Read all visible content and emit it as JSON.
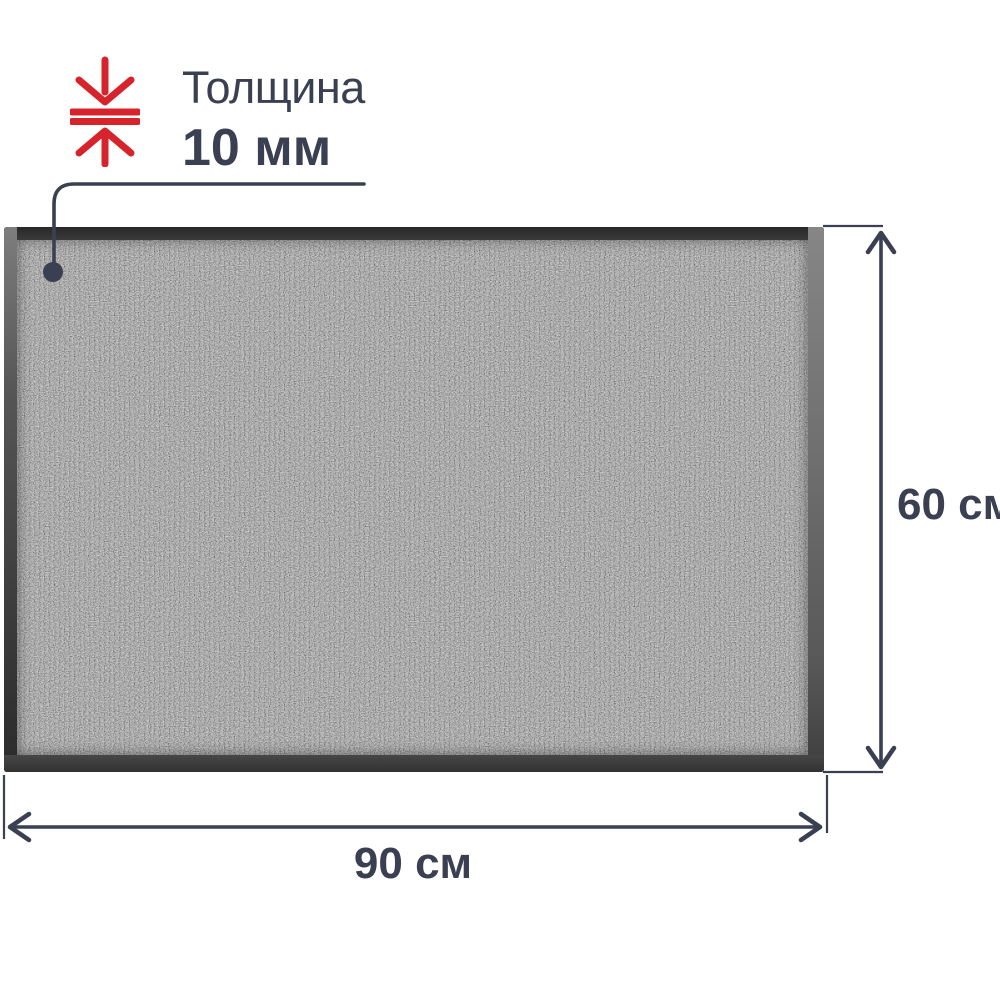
{
  "thickness": {
    "title": "Толщина",
    "value": "10 мм"
  },
  "dimensions": {
    "height": "60 см",
    "width": "90 см"
  },
  "icons": {
    "thickness_icon": "compress-arrows-vertical-icon"
  },
  "colors": {
    "accent_red": "#d7232b",
    "annotation_slate": "#3a4052",
    "background": "#ffffff",
    "mat_rubber_border": "#3a3a3a",
    "carpet_gray": "#6b6b6b"
  }
}
